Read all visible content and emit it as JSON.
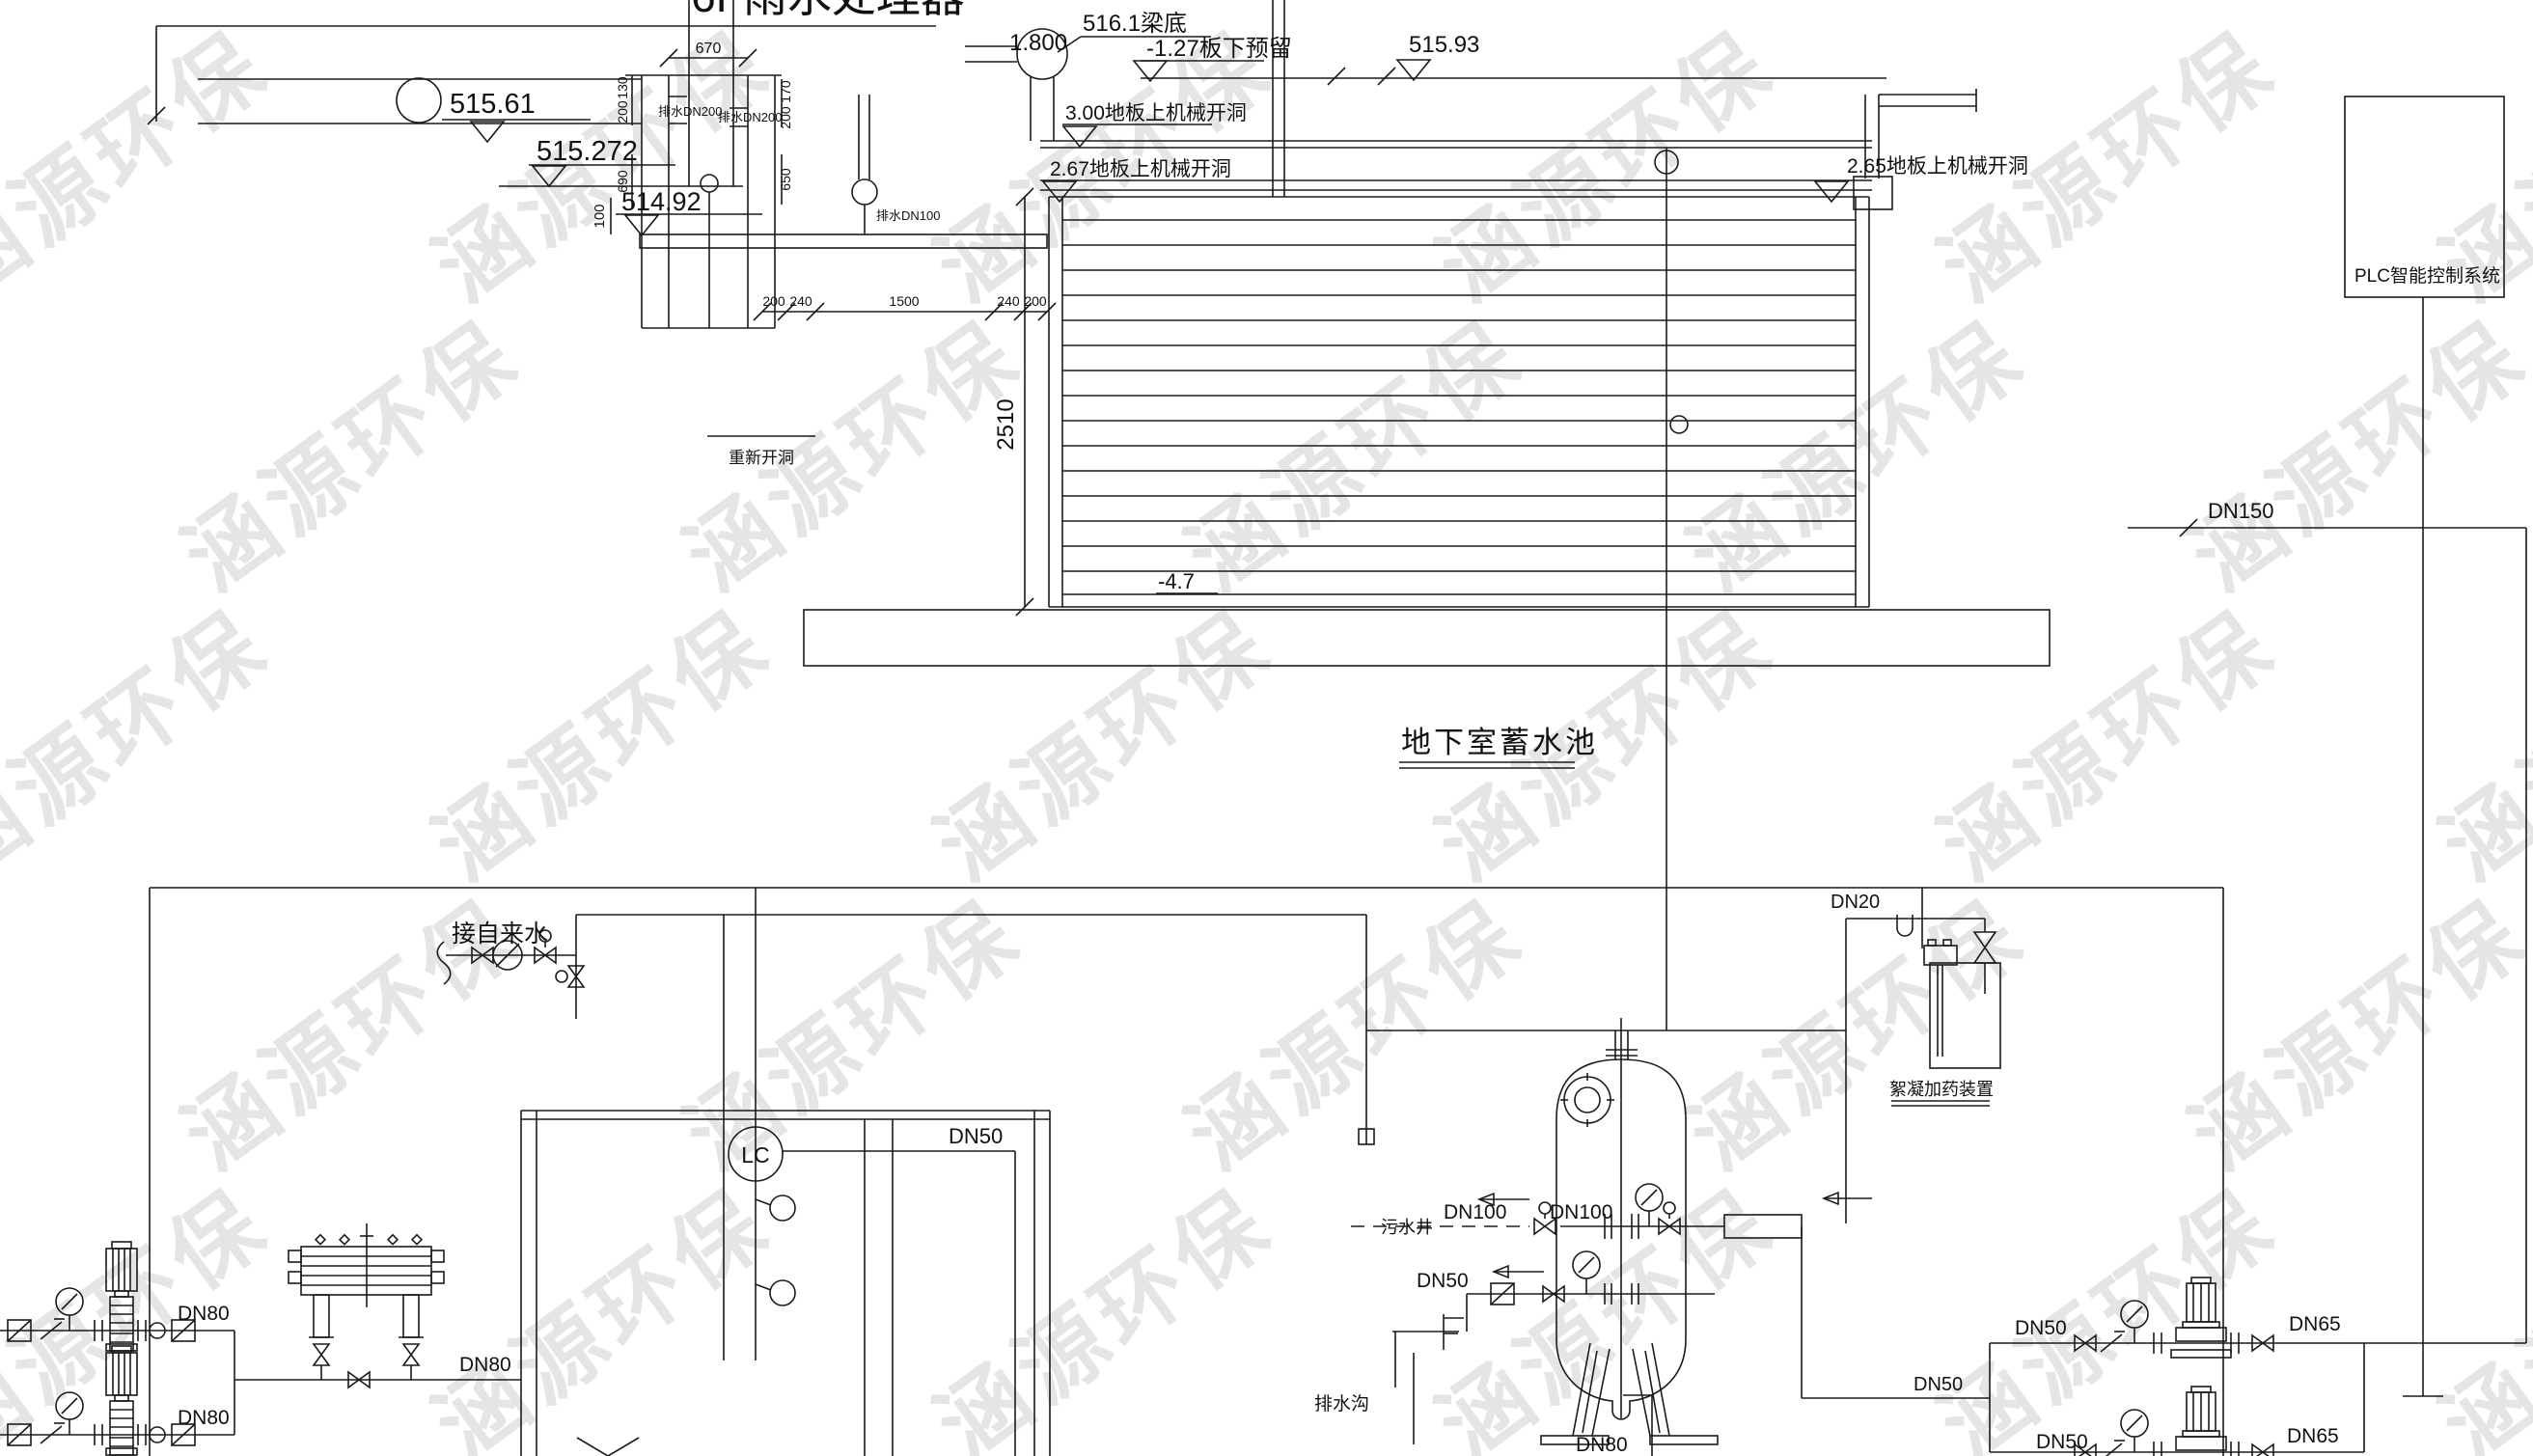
{
  "watermark": {
    "text": "涵源环保"
  },
  "upper": {
    "building_label": "6F雨水处理器",
    "elev_pipe_1": "515.61",
    "elev_pipe_2": "515.272",
    "elev_floor": "514.92",
    "dim_100": "100",
    "dim_670": "670",
    "dim_130": "130",
    "dim_200_left": "200",
    "dim_170": "170",
    "dim_200_right": "200",
    "dim_690": "690",
    "dim_650": "650",
    "dims_bottom": [
      "200",
      "240",
      "1500",
      "240",
      "200"
    ],
    "pipe_dn200_left": "排水DN200",
    "pipe_dn200_right": "排水DN200",
    "pipe_dn100": "排水DN100",
    "elev_beam": "516.1梁底",
    "elev_1800": "1.800",
    "note_slab_reserve": "-1.27板下预留",
    "elev_51593": "515.93",
    "note_open_300": "3.00地板上机械开洞",
    "note_open_267": "2.67地板上机械开洞",
    "note_open_265": "2.65地板上机械开洞",
    "note_reopen": "重新开洞",
    "dim_tank_height": "2510",
    "elev_tank_bottom": "-4.7",
    "tank_title": "地下室蓄水池"
  },
  "right_side": {
    "plc_label": "PLC智能控制系统",
    "dn150": "DN150"
  },
  "lower": {
    "tap_water": "接自来水",
    "dn20": "DN20",
    "dosing_label": "絮凝加药装置",
    "level_controller": "LC",
    "dn50_level": "DN50",
    "sewage_well": "污水井",
    "dn100_a": "DN100",
    "dn100_b": "DN100",
    "dn50_backwash": "DN50",
    "drain_ditch": "排水沟",
    "dn80_drain": "DN80",
    "dn80_pump_1": "DN80",
    "dn80_pump_2": "DN80",
    "dn80_header": "DN80",
    "dn50_feed": "DN50",
    "dn50_pump_1": "DN50",
    "dn50_pump_2": "DN50",
    "dn65_pump_1": "DN65",
    "dn65_pump_2": "DN65"
  },
  "colors": {
    "line": "#1b1b1b",
    "pump_cyan": "#19d3e8",
    "valve_green": "#22cc22",
    "equipment_gray": "#8a8a8a",
    "centerline_red": "#e33535"
  }
}
